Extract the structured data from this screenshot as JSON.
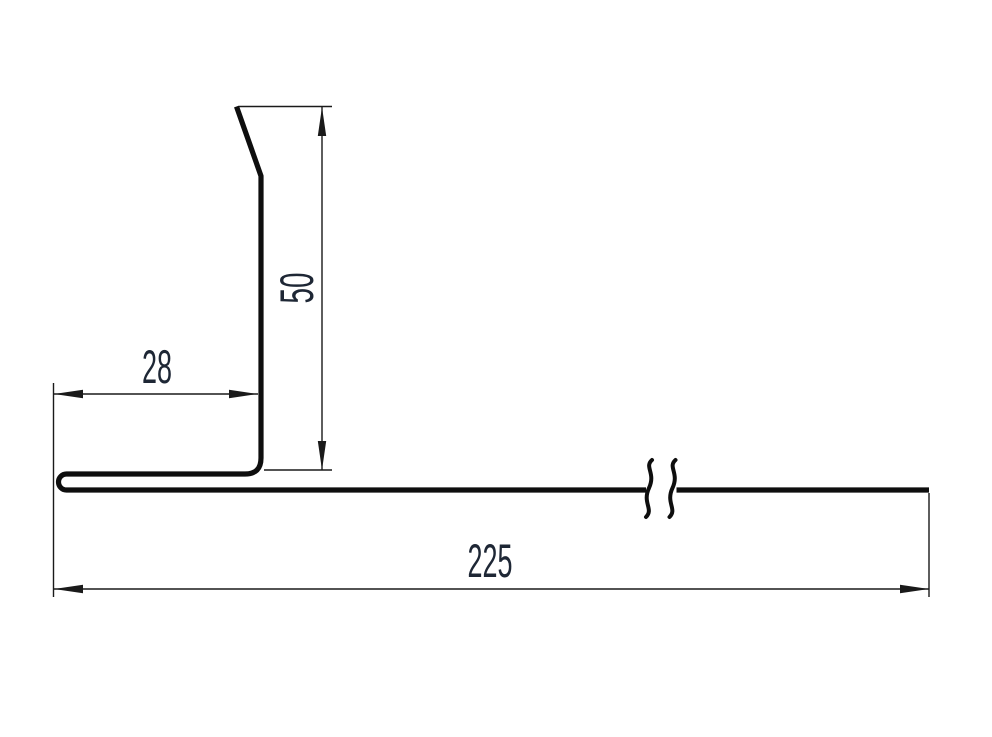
{
  "drawing": {
    "description": "Cross-section profile drawing of a bent sheet-metal flashing with hemmed edge",
    "background_color": "#ffffff",
    "line_color": "#0e0e0e",
    "dimension_line_color": "#1a1a1a",
    "text_color": "#1e2735",
    "dimensions": {
      "flange_width": {
        "value": "28",
        "orientation": "horizontal"
      },
      "upstand_height": {
        "value": "50",
        "orientation": "vertical"
      },
      "base_length": {
        "value": "225",
        "orientation": "horizontal"
      }
    }
  }
}
